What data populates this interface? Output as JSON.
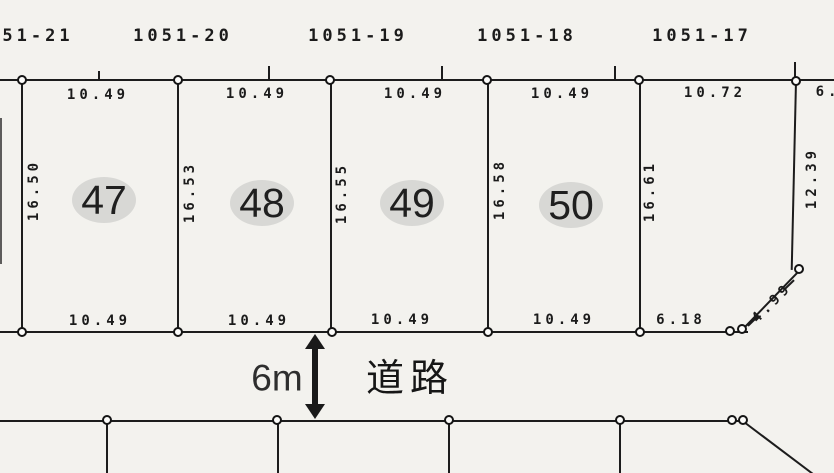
{
  "colors": {
    "paper": "#f3f2ee",
    "ink": "#1c1c1c",
    "parcel_highlight": "#d8d8d5"
  },
  "lots_above": {
    "labels": [
      "51-21",
      "1051-20",
      "1051-19",
      "1051-18",
      "1051-17"
    ]
  },
  "parcels": {
    "items": [
      {
        "number": "47",
        "top_dim": "10.49",
        "side_dim": "16.50",
        "bottom_dim": "10.49"
      },
      {
        "number": "48",
        "top_dim": "10.49",
        "side_dim": "16.53",
        "bottom_dim": "10.49"
      },
      {
        "number": "49",
        "top_dim": "10.49",
        "side_dim": "16.55",
        "bottom_dim": "10.49"
      },
      {
        "number": "50",
        "top_dim": "10.49",
        "side_dim": "16.58",
        "bottom_dim": "10.49"
      }
    ],
    "east_parcel": {
      "top_dim": "10.72",
      "side_dim": "16.61",
      "right_dim": "12.39",
      "bottom_dim": "6.18",
      "chamfer_dim": "4.99"
    },
    "cut_dim_right_edge": "6."
  },
  "road": {
    "width_label": "6m",
    "name": "道路"
  }
}
